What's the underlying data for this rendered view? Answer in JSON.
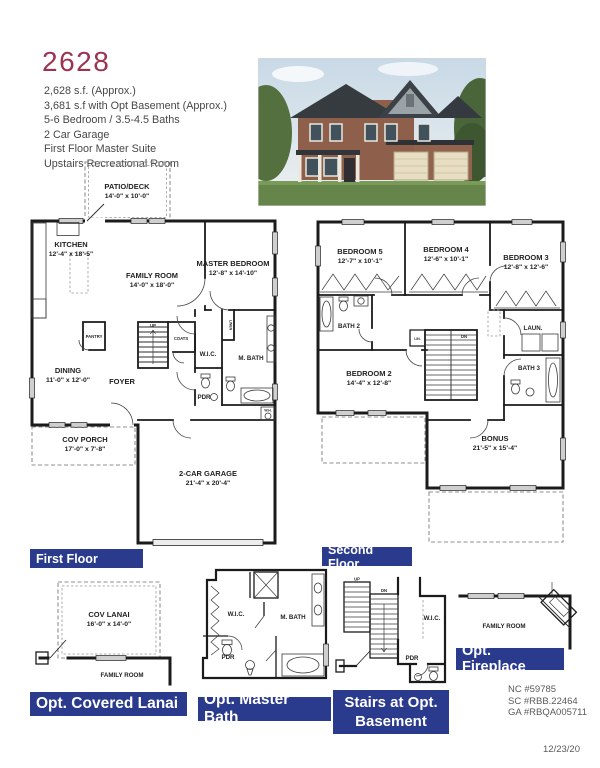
{
  "colors": {
    "label_bar_blue": "#2a3a8d",
    "model_red": "#9c3450",
    "wall_black": "#1b1b1b"
  },
  "header": {
    "model": "2628",
    "specs": [
      "2,628 s.f. (Approx.)",
      "3,681 s.f  with Opt Basement (Approx.)",
      "5-6 Bedroom / 3.5-4.5 Baths",
      "2 Car Garage",
      "First Floor Master Suite",
      "Upstairs Recreational Room"
    ]
  },
  "floor1": {
    "bar": "First Floor",
    "patio_name": "PATIO/DECK",
    "patio_dims": "14'-0\" x 10'-0\"",
    "kitchen_name": "KITCHEN",
    "kitchen_dims": "12'-4\" x 18'-5\"",
    "family_name": "FAMILY ROOM",
    "family_dims": "14'-0\" x 18'-0\"",
    "master_name": "MASTER BEDROOM",
    "master_dims": "12'-8\" x 14'-10\"",
    "dining_name": "DINING",
    "dining_dims": "11'-0\" x 12'-0\"",
    "foyer": "FOYER",
    "porch_name": "COV PORCH",
    "porch_dims": "17'-0\" x 7'-8\"",
    "garage_name": "2-CAR GARAGE",
    "garage_dims": "21'-4\" x 20'-4\"",
    "pantry": "PANTRY",
    "coats": "COATS",
    "wic": "W.I.C.",
    "mbath": "M. BATH",
    "pdr": "PDR",
    "linen": "LINEN",
    "wh": "W.H.",
    "up": "UP"
  },
  "floor2": {
    "bar": "Second Floor",
    "bed5_name": "BEDROOM 5",
    "bed5_dims": "12'-7\" x 10'-1\"",
    "bed4_name": "BEDROOM 4",
    "bed4_dims": "12'-6\" x 10'-1\"",
    "bed3_name": "BEDROOM 3",
    "bed3_dims": "12'-8\" x 12'-6\"",
    "bed2_name": "BEDROOM 2",
    "bed2_dims": "14'-4\" x 12'-8\"",
    "bonus_name": "BONUS",
    "bonus_dims": "21'-5\" x 15'-4\"",
    "bath2": "BATH 2",
    "bath3": "BATH 3",
    "laun": "LAUN.",
    "lin": "LIN.",
    "dn": "DN"
  },
  "opt_lanai": {
    "bar": "Opt. Covered Lanai",
    "name": "COV LANAI",
    "dims": "16'-0\" x  14'-0\"",
    "family": "FAMILY ROOM"
  },
  "opt_mbath": {
    "bar": "Opt. Master Bath",
    "wic": "W.I.C.",
    "mbath": "M. BATH",
    "pdr": "PDR"
  },
  "opt_stairs": {
    "bar1": "Stairs at Opt.",
    "bar2": "Basement",
    "wic": "W.I.C.",
    "pdr": "PDR",
    "up": "UP",
    "dn": "DN"
  },
  "opt_fireplace": {
    "bar": "Opt. Fireplace",
    "family": "FAMILY ROOM"
  },
  "footer": {
    "licenses": [
      "NC #59785",
      "SC #RBB.22464",
      "GA #RBQA005711"
    ],
    "date": "12/23/20"
  }
}
